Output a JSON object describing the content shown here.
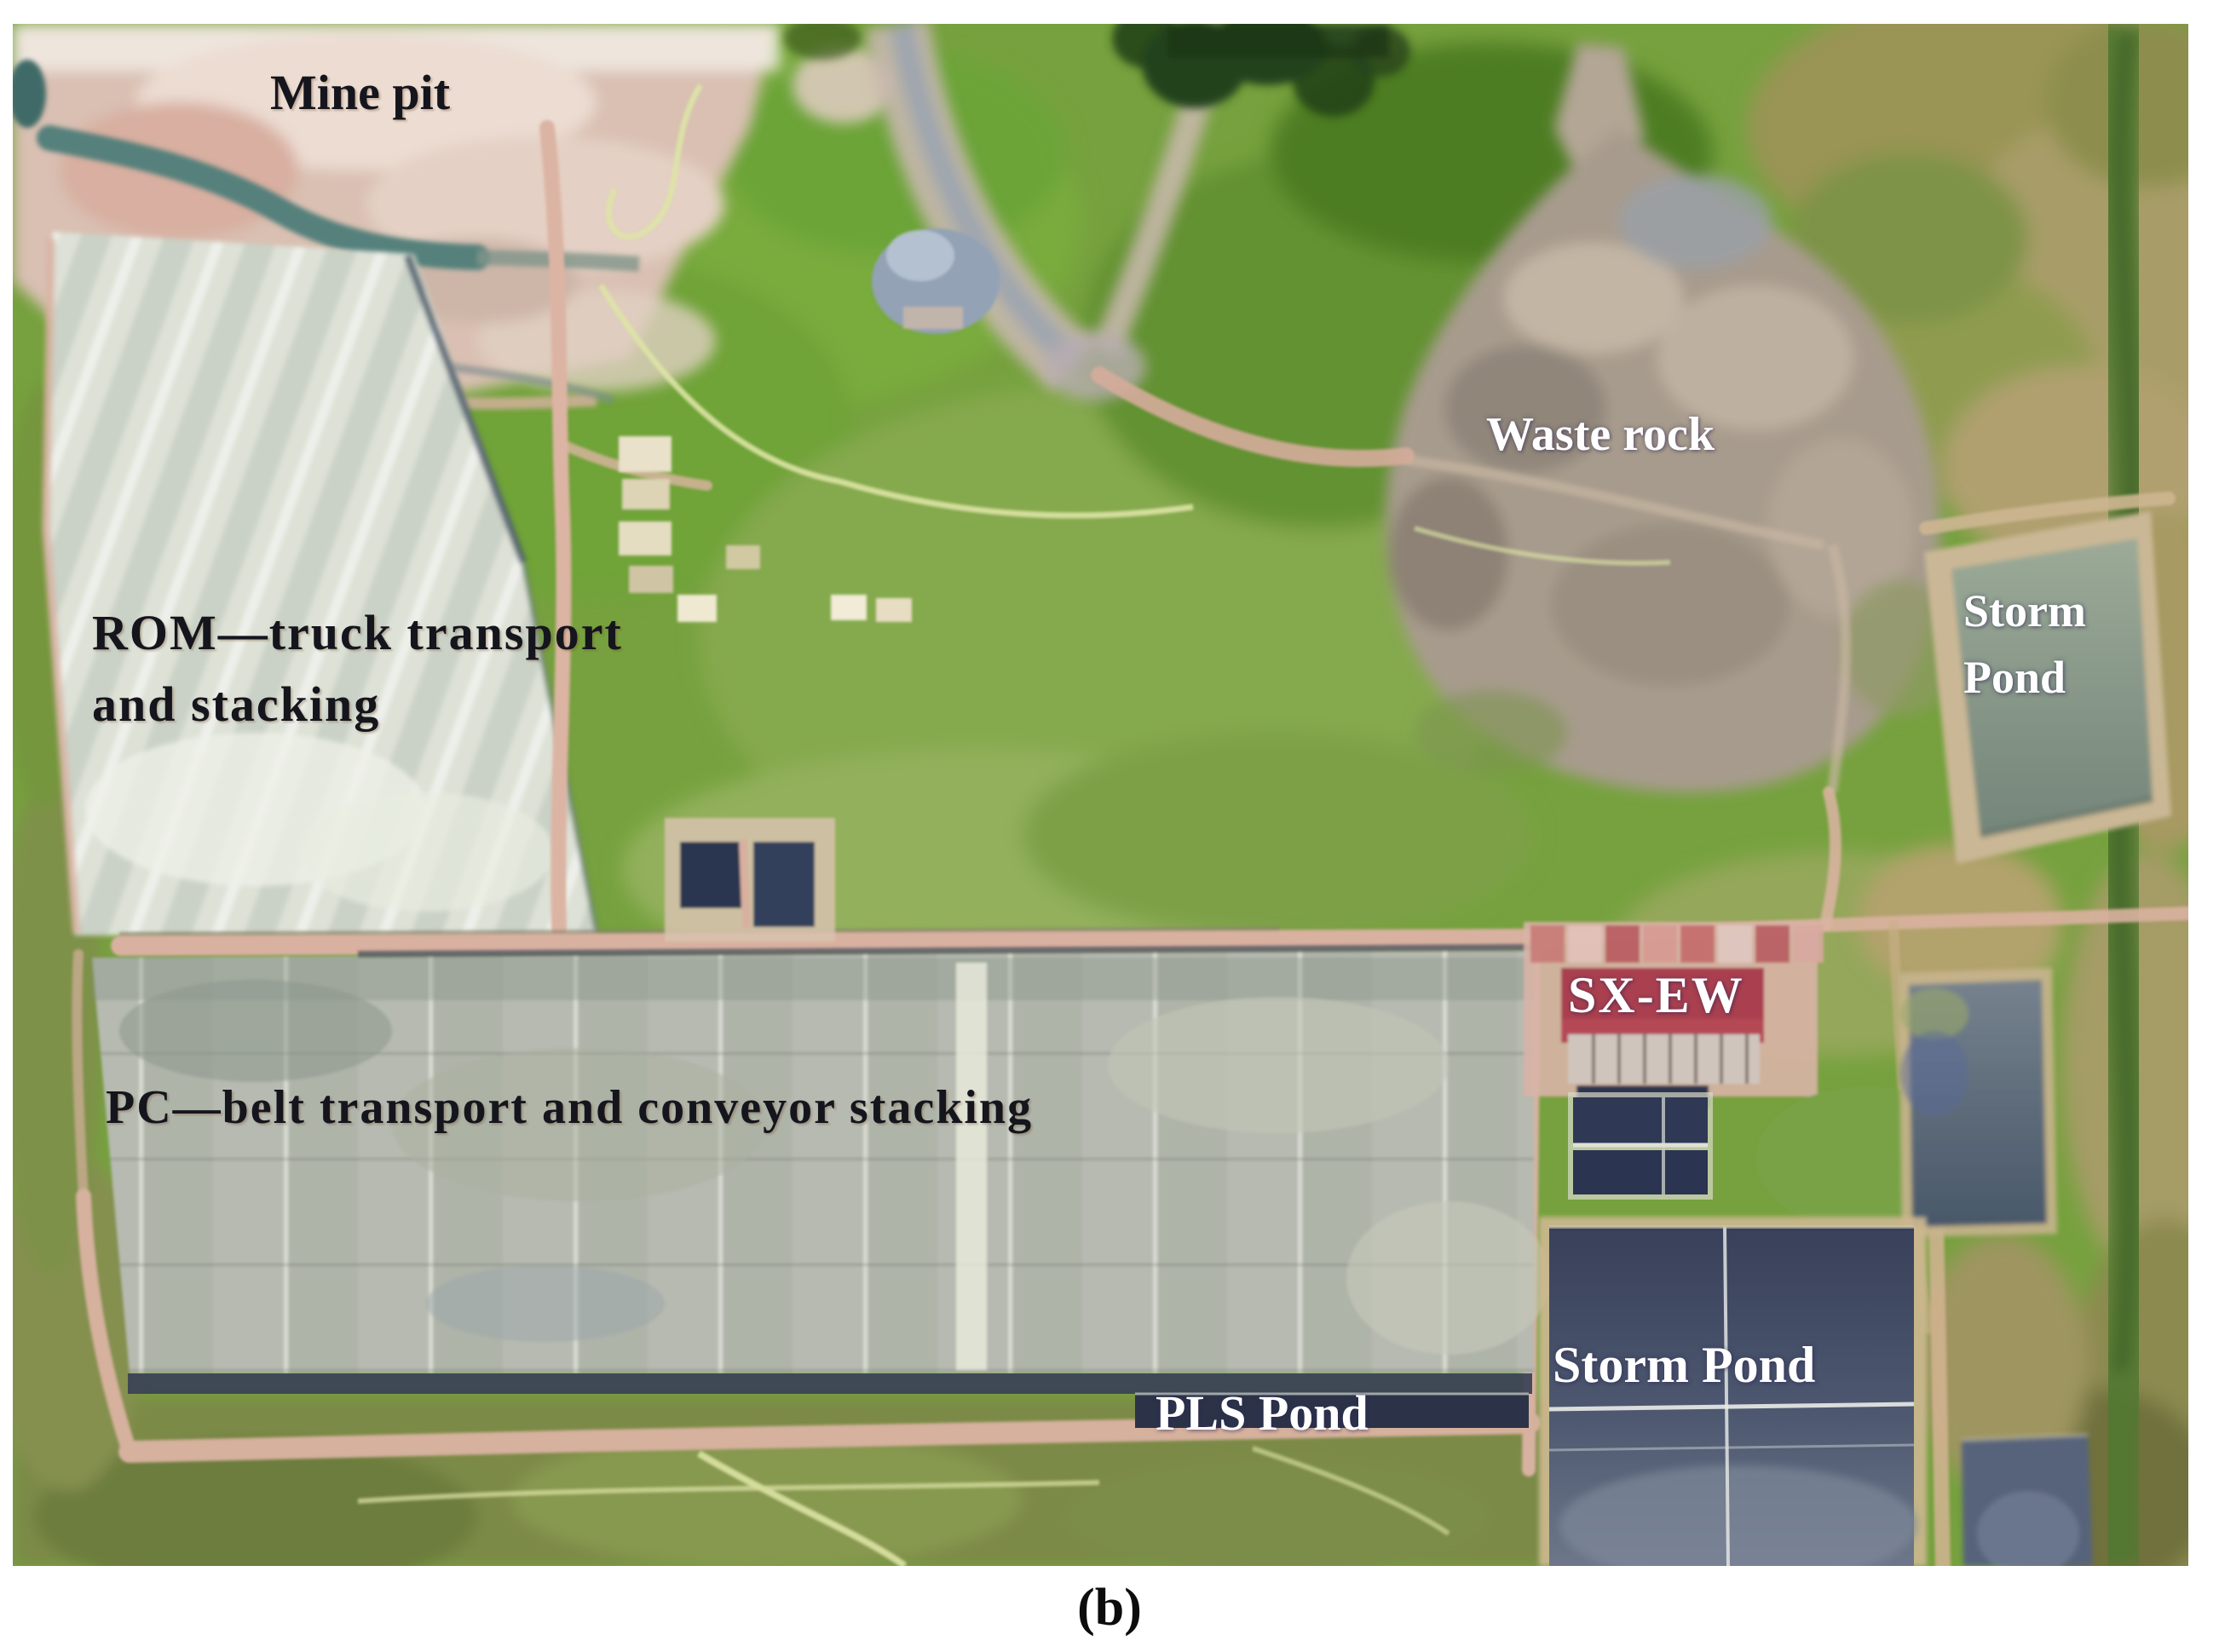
{
  "figure": {
    "caption": "(b)",
    "description_labels_visible": 8
  },
  "labels": {
    "mine_pit": "Mine pit",
    "rom_line1": "ROM—truck transport",
    "rom_line2": "and stacking",
    "waste_rock": "Waste rock",
    "storm_pond_upper_line1": "Storm",
    "storm_pond_upper_line2": "Pond",
    "pc_belt": "PC—belt transport and conveyor stacking",
    "sx_ew": "SX-EW",
    "storm_pond_lower": "Storm Pond",
    "pls_pond": "PLS Pond"
  },
  "colors": {
    "label_dark": "#15151d",
    "label_light": "#ffffff",
    "vegetation_green": "#76a13e",
    "mine_pit_pink": "#d9c0b2",
    "rom_pad_light_gray": "#dde1d6",
    "pc_pad_gray": "#b6bab0",
    "waste_rock_gray_brown": "#a79b8d",
    "storm_pond_upper_gray_green": "#8e9c8e",
    "storm_pond_lower_navy": "#3a415a",
    "pls_pond_navy": "#2c3349",
    "sx_ew_roof_red": "#aa4150",
    "road_pink": "#dcb4a3"
  }
}
